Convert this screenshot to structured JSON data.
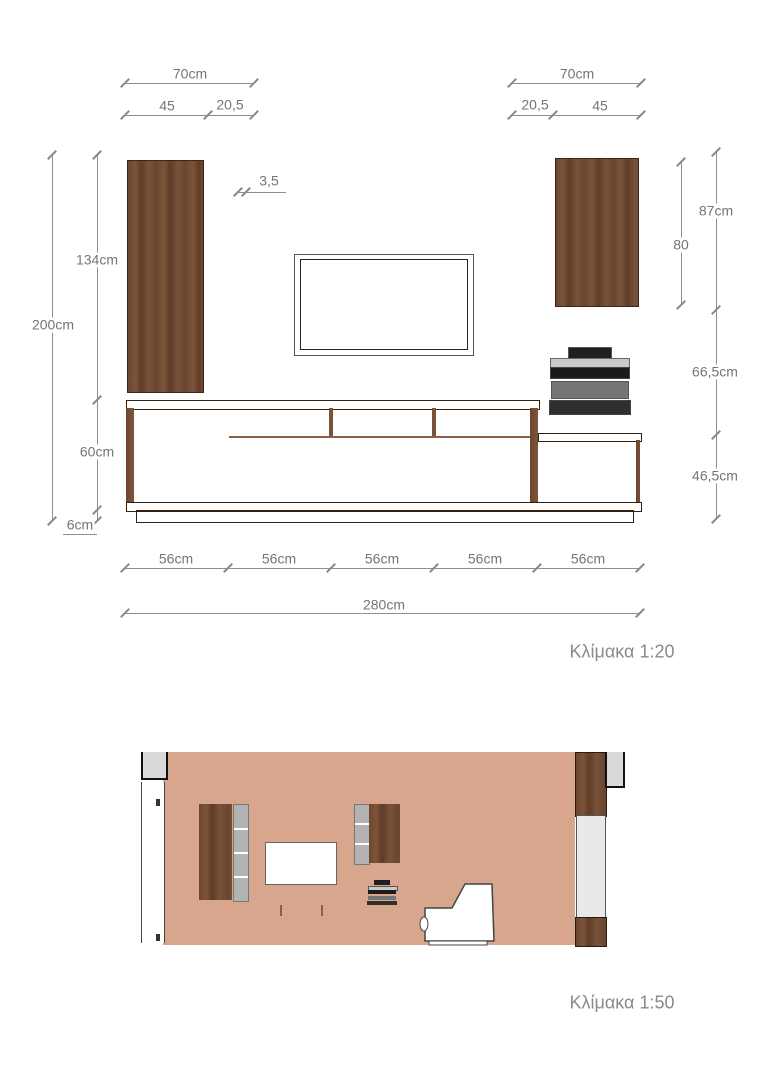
{
  "top_view": {
    "scale": "Κλίμακα 1:20",
    "left_cabinet": {
      "width": "70cm",
      "door_width": "45",
      "shelf_width": "20,5"
    },
    "right_cabinet": {
      "width": "70cm",
      "shelf_width": "20,5",
      "door_width": "45"
    },
    "panel_thickness": "3,5",
    "heights_left": {
      "total": "200cm",
      "tall_unit": "134cm",
      "base_unit": "60cm",
      "plinth": "6cm"
    },
    "heights_right": {
      "wall_unit": "87cm",
      "wall_unit_inner": "80",
      "mid_gap": "66,5cm",
      "low_unit": "46,5cm"
    },
    "doors": [
      "56cm",
      "56cm",
      "56cm",
      "56cm",
      "56cm"
    ],
    "total_width": "280cm"
  },
  "section_view": {
    "scale": "Κλίμακα 1:50"
  },
  "colors": {
    "wood": "#6b4630",
    "wood_dark_niche": "#382313",
    "shelf_gray": "#b3b3b3",
    "wall_tan": "#d7a68c",
    "slab_gray": "#d5d5d5",
    "dim_text": "#757575",
    "audio_light": "#c9c9c9",
    "audio_mid": "#757575",
    "audio_dark": "#2e2e2e",
    "audio_black": "#1b1b1b"
  }
}
